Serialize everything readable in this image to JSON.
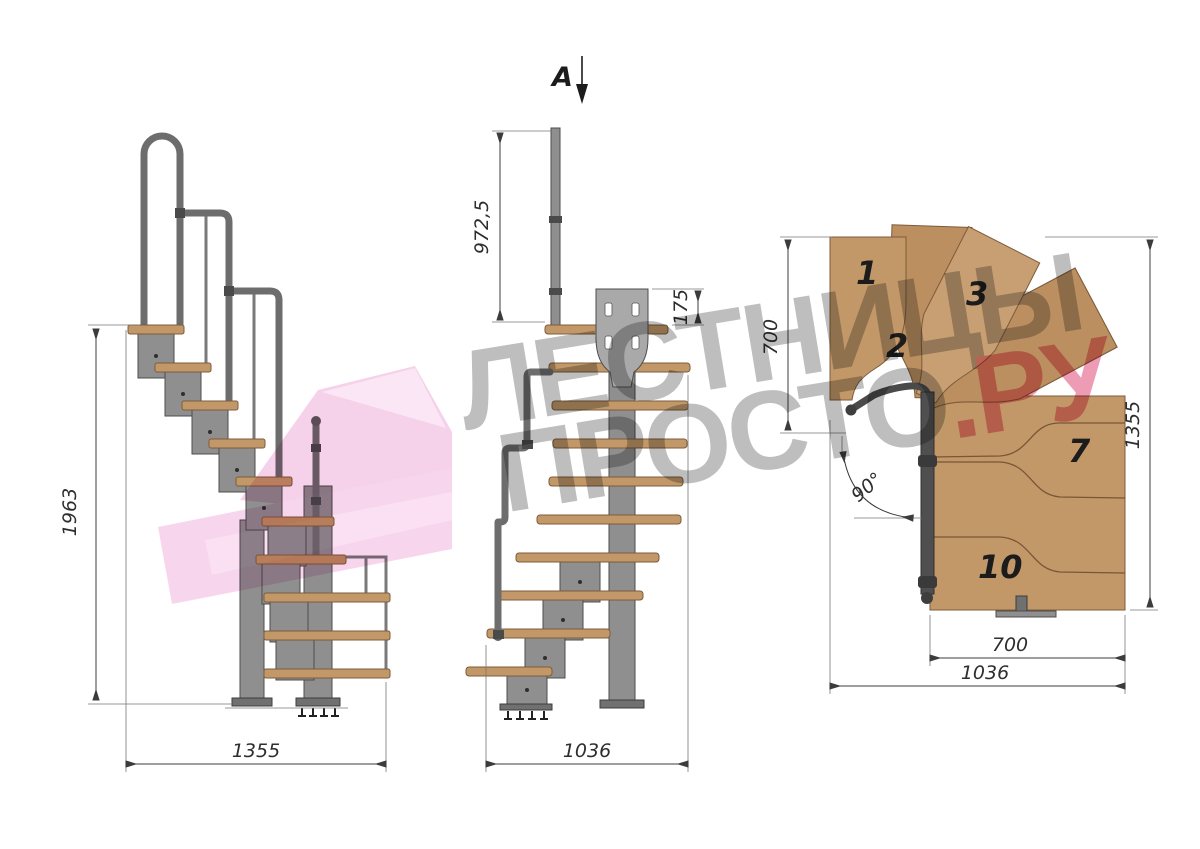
{
  "drawing": {
    "section_marker": "A",
    "side_view": {
      "height": "1963",
      "length": "1355"
    },
    "front_view": {
      "handrail_post_height": "972,5",
      "mount_plate_height": "175",
      "width": "1036"
    },
    "plan_view": {
      "turn_width": "700",
      "total_length": "1355",
      "tread_length": "700",
      "total_width": "1036",
      "turn_angle": "90°",
      "tread_numbers": {
        "t1": "1",
        "t2": "2",
        "t3": "3",
        "t7": "7",
        "t10": "10"
      }
    }
  },
  "watermark": {
    "line1": "ЛЕСТНИЦЫ",
    "line2_main": "ПРОСТО",
    "line2_accent": ".РУ"
  },
  "colors": {
    "wood": "#c29869",
    "metal": "#8f8f8f",
    "dimension": "#2e2e2e",
    "watermark_gray": "#969696",
    "watermark_pink": "#e35f87",
    "watermark_arrow": "#efa9d9",
    "background": "#ffffff"
  }
}
